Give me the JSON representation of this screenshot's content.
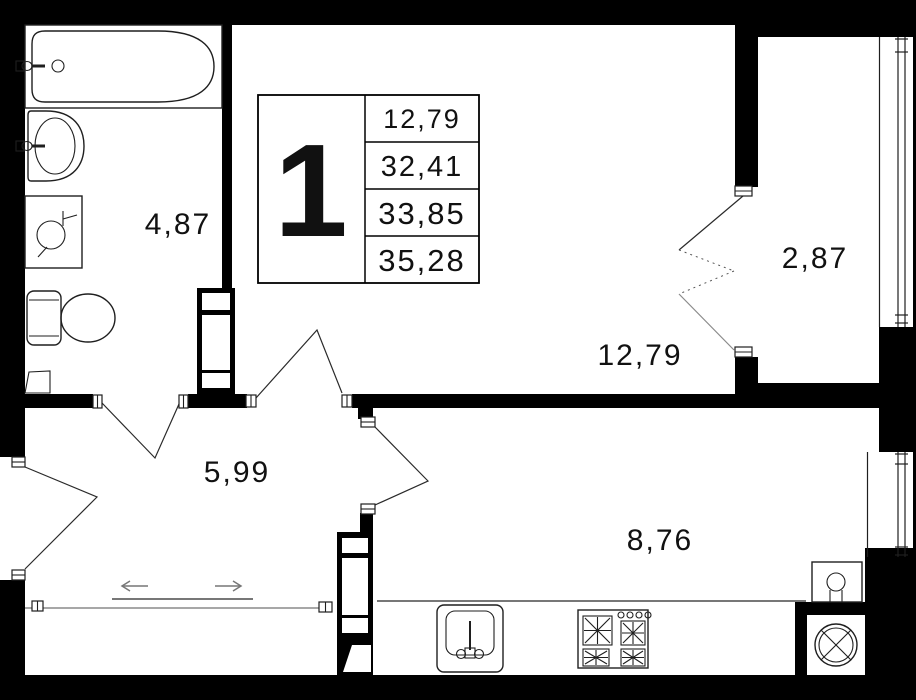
{
  "legend": {
    "unit": "1",
    "values": [
      "12,79",
      "32,41",
      "33,85",
      "35,28"
    ]
  },
  "rooms": {
    "bathroom": "4,87",
    "hallway": "5,99",
    "living": "12,79",
    "balcony": "2,87",
    "kitchen": "8,76"
  },
  "fixtures": [
    "bathtub",
    "bathroom-sink",
    "washing-machine",
    "toilet",
    "cabinet",
    "kitchen-sink",
    "stove",
    "water-heater",
    "washer-dryer"
  ],
  "colors": {
    "wall": "#000000",
    "floor": "#ffffff",
    "line": "#1f1f1f",
    "gray": "#8a8a8a",
    "text": "#111111"
  }
}
